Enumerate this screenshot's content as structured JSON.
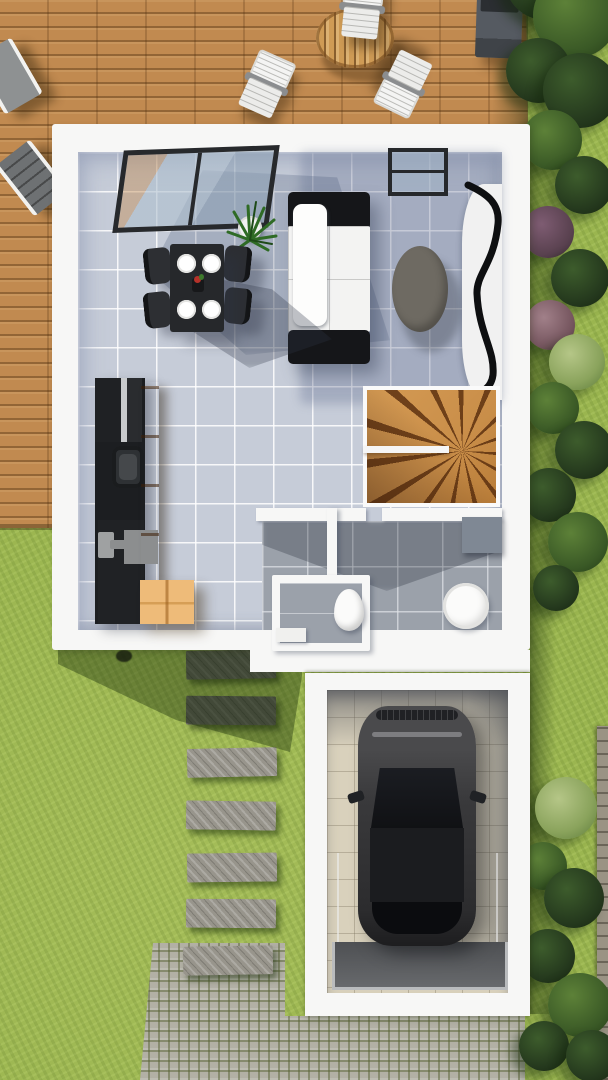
{
  "meta": {
    "title": "Top-down 3D rendering of a ground-floor house plan with terrace, garden and garage",
    "style": "architectural visualization",
    "view": "plan view"
  },
  "palette": {
    "grass": "#9ab54f",
    "shadowGreen": "rgba(25,45,10,0.40)",
    "deck": "#c18a50",
    "wall": "#f7f7f6",
    "tile": "#c6ccd8",
    "tileShade": "rgba(85,100,135,0.30)",
    "bathTile": "#9ba1aa",
    "kitchenDark": "#1c1e21",
    "woodCabinet": "#bd7e3e",
    "crate": "#eebb79",
    "tableDark": "#26282b",
    "chairDark": "#2d2f33",
    "sofaWhite": "#f3f3f2",
    "sofaDark": "#151619",
    "rug": "#6e6a62",
    "stairWood": "#c98e49",
    "stairDark": "rgba(86,43,12,0.8)",
    "garageFloor": "#d9d1bc",
    "garageShade": "rgba(75,78,85,0.55)",
    "carBody": "#39393b",
    "carGlass": "#101114",
    "paver": "#98958c",
    "cobble": "#b2b0a5",
    "cobbleGap": "rgba(90,100,55,0.5)",
    "fence": "#9a9384",
    "potWhite": "#f2f2f2",
    "plantGreen": "#2f6b25"
  },
  "scene": {
    "deck": {
      "name": "wooden terrace",
      "furniture": [
        "sun lounger",
        "sun lounger",
        "folding chair",
        "folding chair",
        "folding chair",
        "round slatted table",
        "barbecue grill"
      ]
    },
    "garden": {
      "name": "lawn",
      "hedgerow_side": "east",
      "bushes": [
        {
          "cx": 545,
          "cy": -20,
          "d": 80,
          "tone": "dark"
        },
        {
          "cx": 575,
          "cy": 15,
          "d": 85,
          "tone": "mid"
        },
        {
          "cx": 538,
          "cy": 70,
          "d": 65,
          "tone": "dark"
        },
        {
          "cx": 580,
          "cy": 90,
          "d": 75,
          "tone": "dark"
        },
        {
          "cx": 552,
          "cy": 140,
          "d": 60,
          "tone": "mid"
        },
        {
          "cx": 584,
          "cy": 185,
          "d": 58,
          "tone": "dark"
        },
        {
          "cx": 548,
          "cy": 232,
          "d": 52,
          "tone": "purple"
        },
        {
          "cx": 580,
          "cy": 278,
          "d": 58,
          "tone": "dark"
        },
        {
          "cx": 550,
          "cy": 325,
          "d": 50,
          "tone": "rose"
        },
        {
          "cx": 577,
          "cy": 362,
          "d": 56,
          "tone": "light"
        },
        {
          "cx": 553,
          "cy": 408,
          "d": 52,
          "tone": "mid"
        },
        {
          "cx": 584,
          "cy": 450,
          "d": 58,
          "tone": "dark"
        },
        {
          "cx": 549,
          "cy": 495,
          "d": 54,
          "tone": "dark"
        },
        {
          "cx": 578,
          "cy": 542,
          "d": 60,
          "tone": "mid"
        },
        {
          "cx": 556,
          "cy": 588,
          "d": 46,
          "tone": "dark"
        },
        {
          "cx": 566,
          "cy": 808,
          "d": 62,
          "tone": "light"
        },
        {
          "cx": 543,
          "cy": 866,
          "d": 48,
          "tone": "mid"
        },
        {
          "cx": 574,
          "cy": 898,
          "d": 60,
          "tone": "dark"
        },
        {
          "cx": 548,
          "cy": 956,
          "d": 54,
          "tone": "dark"
        },
        {
          "cx": 580,
          "cy": 1005,
          "d": 64,
          "tone": "mid"
        },
        {
          "cx": 544,
          "cy": 1046,
          "d": 50,
          "tone": "dark"
        },
        {
          "cx": 592,
          "cy": 1056,
          "d": 52,
          "tone": "dark"
        }
      ],
      "stepping_stones": [
        {
          "x": 186,
          "y": 650,
          "rot": -1.0,
          "shaded": true
        },
        {
          "x": 186,
          "y": 696,
          "rot": 0.5,
          "shaded": true
        },
        {
          "x": 187,
          "y": 748,
          "rot": -1.2,
          "shaded": false
        },
        {
          "x": 186,
          "y": 801,
          "rot": 0.8,
          "shaded": false
        },
        {
          "x": 187,
          "y": 853,
          "rot": -0.6,
          "shaded": false
        },
        {
          "x": 186,
          "y": 899,
          "rot": 0.4,
          "shaded": false
        },
        {
          "x": 183,
          "y": 946,
          "rot": -1.0,
          "shaded": false
        }
      ],
      "cobblestone_path": true
    },
    "house": {
      "name": "ground floor",
      "rooms": [
        {
          "name": "living room",
          "furniture": [
            "sofa",
            "coffee table",
            "curved media unit",
            "potted plant",
            "bay window",
            "glass door"
          ]
        },
        {
          "name": "dining area",
          "furniture": [
            "dark dining table",
            "4 chairs",
            "4 plates",
            "centerpiece"
          ]
        },
        {
          "name": "kitchen",
          "furniture": [
            "black counter",
            "sink",
            "tall wood cabinet",
            "wooden crate"
          ]
        },
        {
          "name": "stairwell",
          "furniture": [
            "wooden winder staircase"
          ]
        },
        {
          "name": "bathroom",
          "furniture": [
            "round shower basin",
            "wall cabinet"
          ]
        },
        {
          "name": "wc",
          "furniture": [
            "toilet"
          ]
        }
      ]
    },
    "garage": {
      "name": "garage",
      "furniture": [
        "dark grey SUV",
        "door ramp"
      ]
    }
  }
}
